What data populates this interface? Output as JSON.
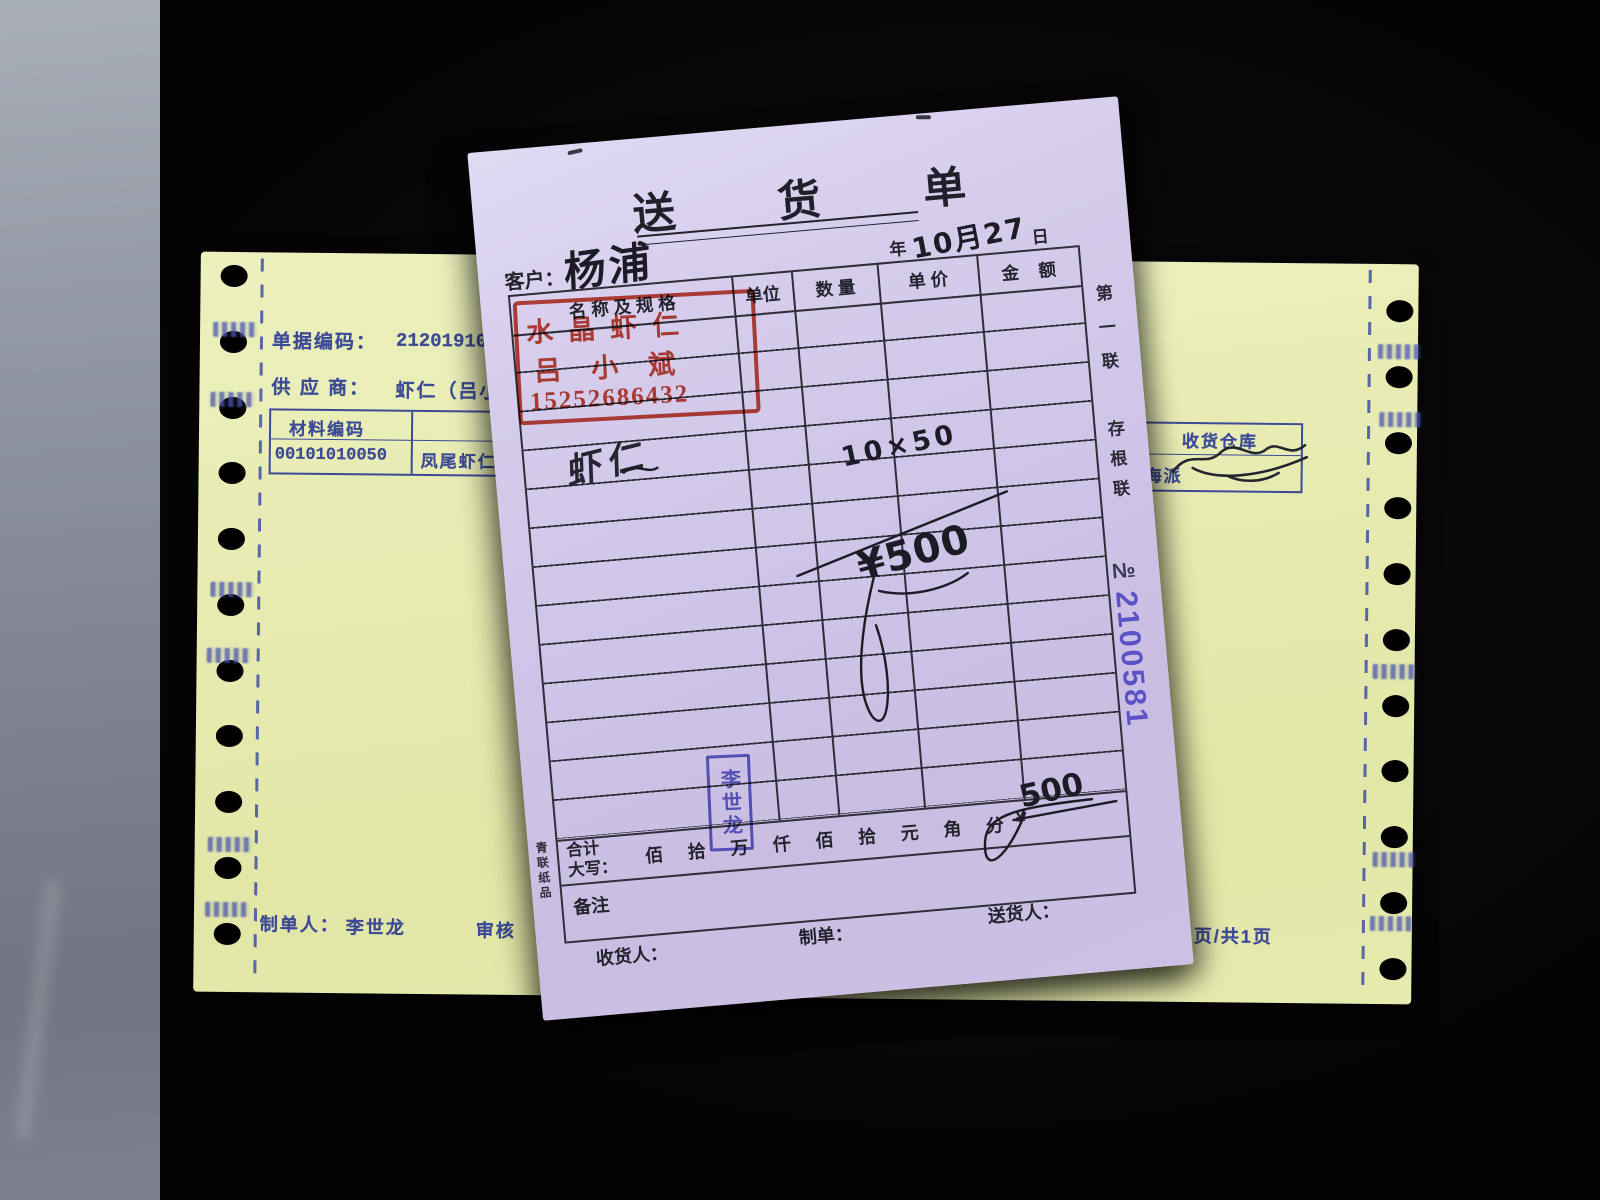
{
  "colors": {
    "ink": "#1c1c26",
    "print": "#2e2e38",
    "red_stamp": "#c43a28",
    "blue_stamp": "#5353c2",
    "serial": "#5a52c6",
    "navy_print": "#3d4b96"
  },
  "delivery_note": {
    "title": "送 货 单",
    "date": {
      "year": "年",
      "handwritten": "10月27",
      "day": "日"
    },
    "customer": {
      "label": "客户：",
      "handwritten": "杨浦"
    },
    "table": {
      "headers": {
        "name": "名 称 及 规 格",
        "unit": "单位",
        "qty": "数 量",
        "price": "单 价",
        "amount": "金    额"
      }
    },
    "red_stamp": {
      "line1": "水晶虾仁",
      "line2": "吕小斌",
      "line3": "15252686432"
    },
    "handwritten": {
      "item": "虾仁",
      "qty_price": "10×50",
      "amount": "¥500",
      "total": "500"
    },
    "side": {
      "copy1": "第一联",
      "copy2": "存根联",
      "no_label": "№",
      "serial": "2100581"
    },
    "totals": {
      "label1": "合计",
      "label2": "大写：",
      "units": [
        "佰",
        "拾",
        "万",
        "仟",
        "佰",
        "拾",
        "元",
        "角",
        "分"
      ],
      "currency": "¥"
    },
    "remarks_label": "备注",
    "printer": "青联纸品",
    "footer": {
      "receiver": "收货人：",
      "maker": "制单：",
      "deliverer": "送货人："
    },
    "blue_stamp": "李世龙"
  },
  "yellow_form": {
    "doc_code": {
      "label": "单据编码：",
      "value": "2120191027"
    },
    "supplier": {
      "label": "供 应 商：",
      "value": "虾仁（吕小"
    },
    "material_table": {
      "col1": "材料编码",
      "col2": "材料",
      "code": "00101010050",
      "name": "凤尾虾仁"
    },
    "warehouse": {
      "label": "收货仓库",
      "value": "海派"
    },
    "footer": {
      "maker_label": "制单人：",
      "maker": "李世龙",
      "audit": "审核",
      "page": "页/共1页"
    }
  }
}
